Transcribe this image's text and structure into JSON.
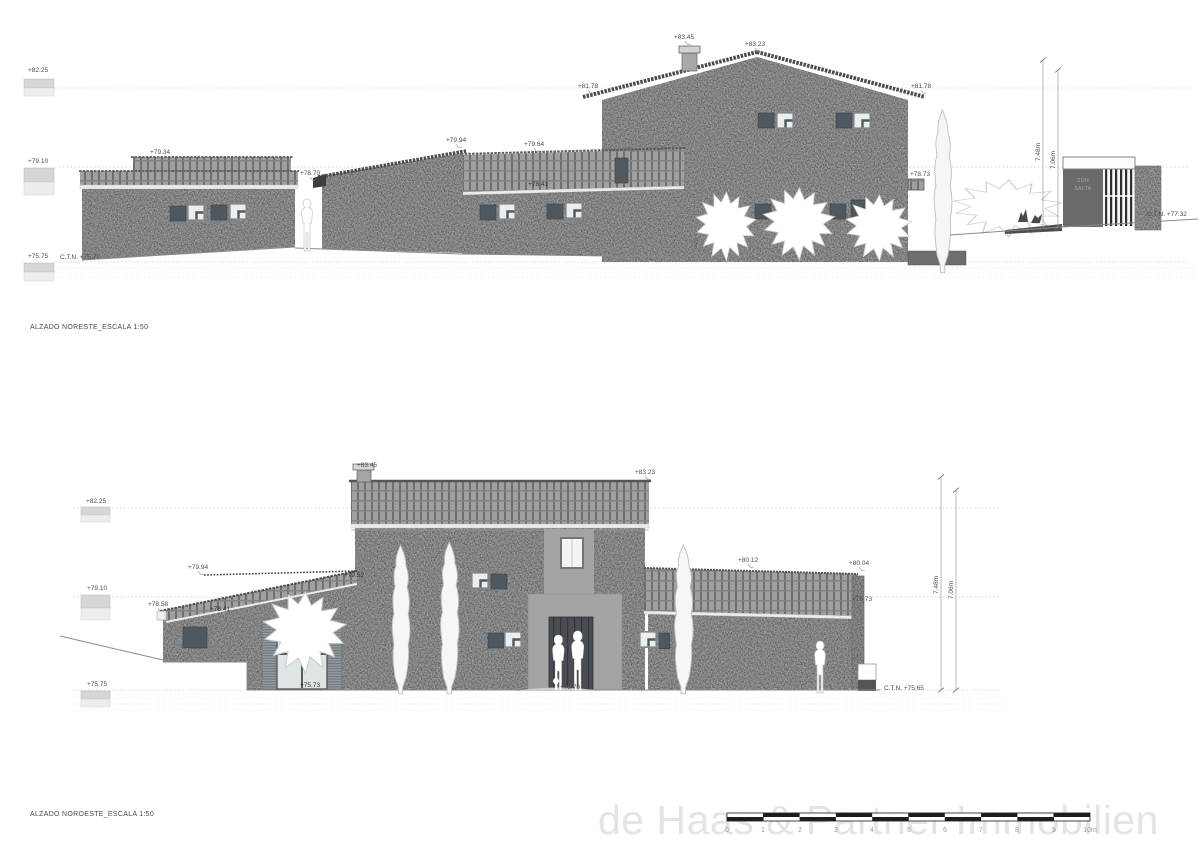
{
  "colors": {
    "stone": "#b2b2b2",
    "roof_tile": "#a0a0a0",
    "roof_rib": "#6f6f6f",
    "window_dark": "#4e585e",
    "window_frame": "#7e868b",
    "gate_wall": "#6a6a6a",
    "door": "#4a4e52",
    "watermark": "#e4e4e4",
    "label_text": "#4c4c4c"
  },
  "watermark": {
    "text": "de Haas & Partner Immobilien"
  },
  "top": {
    "title": "ALZADO NORESTE_ESCALA 1:50",
    "levels": {
      "l1": "+82.25",
      "l2": "+79.10",
      "l3": "+75.75"
    },
    "ctn_left": "C.T.N. +75.77",
    "ctn_right": "C.T.N. +77.32",
    "spots": {
      "left_roof": "+79.34",
      "gap_eave": "+78.70",
      "shed_top": "+79.94",
      "mid_ridge": "+79.64",
      "mid_eave": "+78.41",
      "chimney": "+83.45",
      "ridge": "+83.23",
      "eave_left": "+81.78",
      "eave_right": "+81.78",
      "porch": "+78.73"
    },
    "slope_note": "1.1%",
    "gate": {
      "line1": "SON",
      "line2": "SALTA"
    },
    "dims": {
      "outer": "7.48m",
      "inner": "7.06m"
    }
  },
  "bottom": {
    "title": "ALZADO NOROESTE_ESCALA 1:50",
    "levels": {
      "l1": "+82.25",
      "l2": "+79.10",
      "l3": "+75.75"
    },
    "ctn_right": "C.T.N. +75.65",
    "spots": {
      "chimney": "+83.45",
      "ridge": "+83.23",
      "parapet": "+79.94",
      "left_eave": "+78.58",
      "low_eave": "+78.41",
      "rear_roof": "+79.52",
      "wing_top": "+80.12",
      "wing_end": "+80.04",
      "wing_eave": "+78.73",
      "window_sill": "+75.73",
      "door_sill": "+75.70"
    },
    "dims": {
      "outer": "7.48m",
      "inner": "7.06m"
    }
  },
  "scalebar": {
    "ticks": [
      "0",
      "1",
      "2",
      "3",
      "4",
      "5",
      "6",
      "7",
      "8",
      "9",
      "10m"
    ]
  }
}
